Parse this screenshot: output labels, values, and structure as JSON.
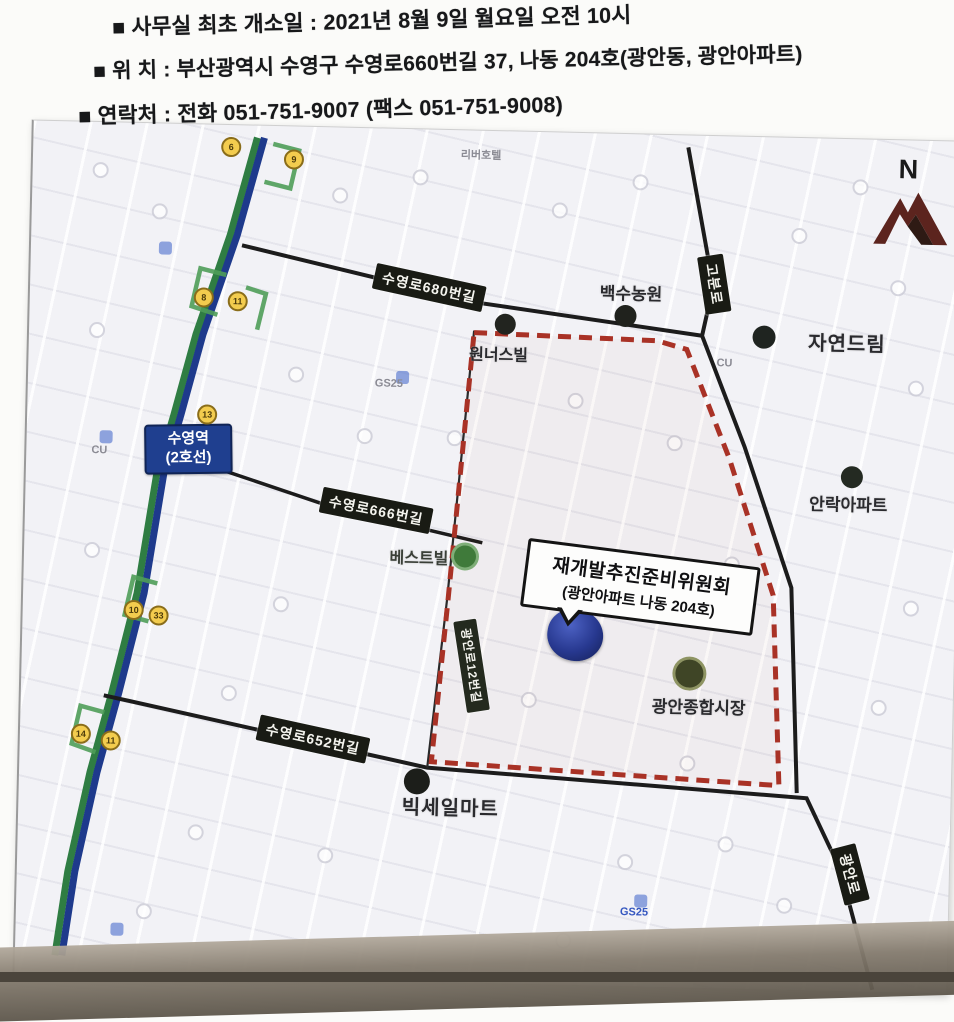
{
  "colors": {
    "subway_blue": "#1e3a8c",
    "route_green": "#2f7d43",
    "boundary_red": "#a93226",
    "road_black": "#1c1c1c",
    "plate_bg": "#191b14",
    "station_blue": "#1f3f8f",
    "marker_blue": "#27388f",
    "north_maroon": "#5c241e",
    "bus_stop_yellow": "#f3cc4e"
  },
  "header": {
    "lines": [
      "■ 사무실 최초 개소일 : 2021년 8월 9일 월요일 오전 10시",
      "■ 위  치 : 부산광역시 수영구 수영로660번길 37, 나동 204호(광안동, 광안아파트)",
      "■ 연락처 : 전화 051-751-9007 (팩스 051-751-9008)"
    ]
  },
  "map": {
    "north_label": "N",
    "station_label": {
      "line1": "수영역",
      "line2": "(2호선)"
    },
    "road_labels": {
      "r680": "수영로680번길",
      "gobunro": "고분로",
      "r666": "수영로666번길",
      "r652": "수영로652번길",
      "west_street": "광안로12번길",
      "gwanganro": "광안로"
    },
    "pois": {
      "wonnersville": "원너스빌",
      "baeksu_farm": "백수농원",
      "jayeon_dream": "자연드림",
      "anrak_apt": "안락아파트",
      "best_ville": "베스트빌",
      "gwangan_market": "광안종합시장",
      "bigsale_mart": "빅세일마트"
    },
    "callout": {
      "line1": "재개발추진준비위원회",
      "line2": "(광안아파트 나동 204호)"
    },
    "bus_stops": [
      "6",
      "9",
      "8",
      "11",
      "13",
      "10",
      "33",
      "14",
      "11"
    ],
    "minor_labels": {
      "cu1": "CU",
      "cu2": "CU",
      "gs1": "GS25",
      "gs2": "GS25",
      "hotel": "리버호텔"
    }
  }
}
